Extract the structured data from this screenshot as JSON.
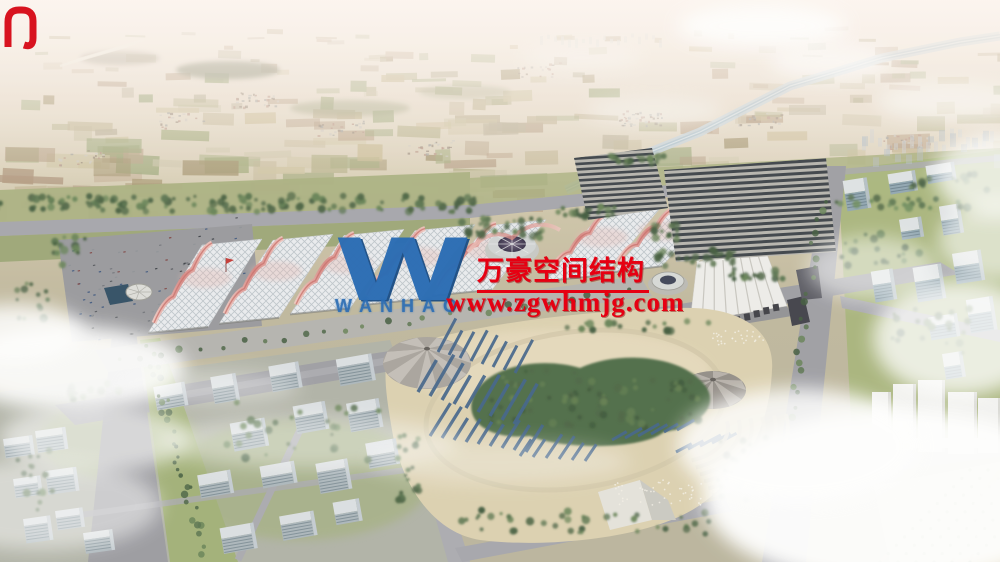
{
  "watermark": {
    "logo_letter": "W",
    "logo_text": "WANHAO",
    "company_name_cn": "万豪空间结构",
    "website": "www.zgwhmjg.com"
  },
  "icons": {
    "logo_mark": "wanhao-w-monogram"
  },
  "palette": {
    "watermark_red": "#e60012",
    "logo_blue": "#2b6db4",
    "sky_haze": "#f5ece7",
    "farmland_tan": "#c4b694",
    "tree_green": "#4e6847",
    "road_gray": "#9b9ba1",
    "hall_roof_white": "#e9ebee",
    "hall_crest_pink": "#dd8f8c",
    "solar_panel_dark": "#32383e",
    "park_sand": "#ddd0ae",
    "park_panel_blue": "#3c5f86",
    "water_blue": "#9db8c9",
    "cloud_white": "#ffffff"
  }
}
